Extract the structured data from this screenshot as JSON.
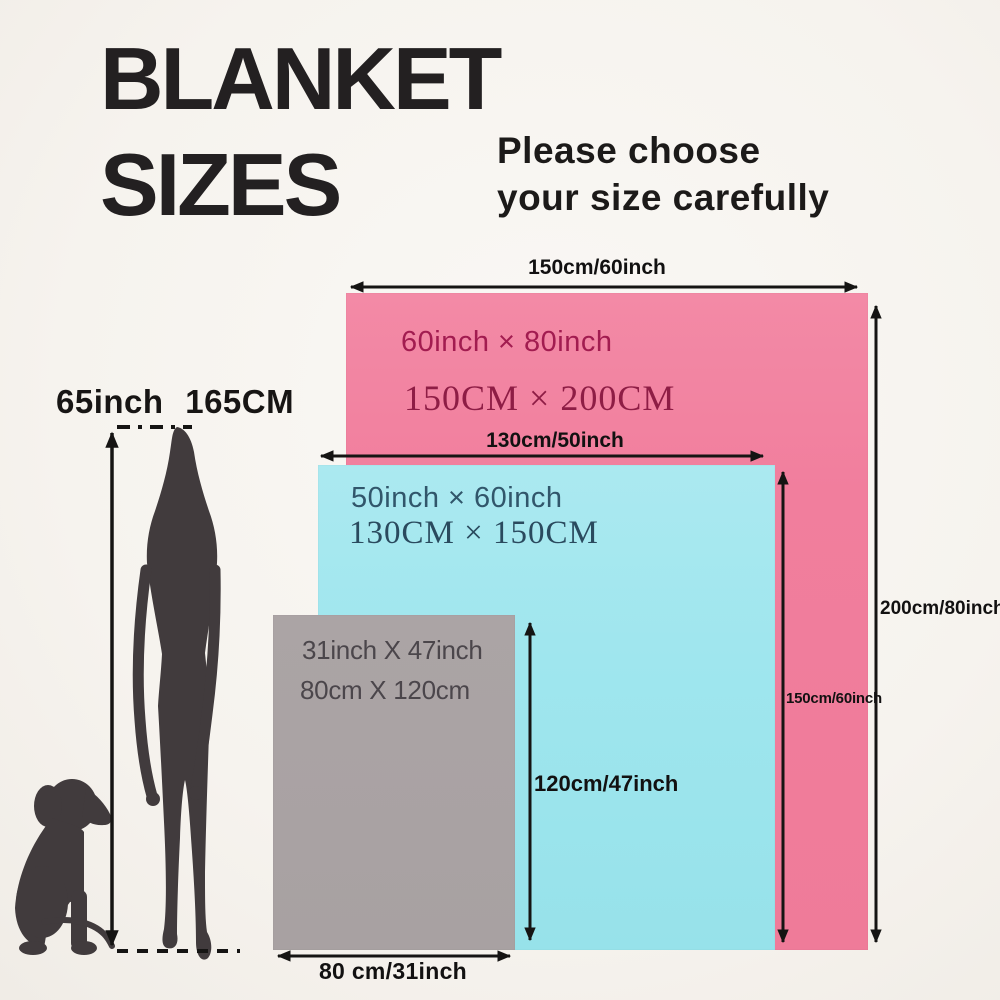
{
  "title": {
    "line1": "BLANKET",
    "line2": "SIZES"
  },
  "subtitle": {
    "line1": "Please choose",
    "line2": "your size carefully"
  },
  "person": {
    "height_label": "65inch 165CM"
  },
  "blankets": {
    "large": {
      "size_inch": "60inch × 80inch",
      "size_cm": "150CM × 200CM",
      "width_label": "150cm/60inch",
      "height_label": "200cm/80inch",
      "color": "#f17e9d"
    },
    "medium": {
      "size_inch": "50inch × 60inch",
      "size_cm": "130CM × 150CM",
      "width_label": "130cm/50inch",
      "height_label": "150cm/60inch",
      "color": "#9fe6ee"
    },
    "small": {
      "size_inch": "31inch X 47inch",
      "size_cm": "80cm X 120cm",
      "width_label": "80 cm/31inch",
      "height_label": "120cm/47inch",
      "color": "#a8a1a2"
    }
  },
  "colors": {
    "background": "#f6f3ee",
    "arrow": "#151413",
    "silhouette": "#413b3d",
    "title_text": "#232021"
  }
}
